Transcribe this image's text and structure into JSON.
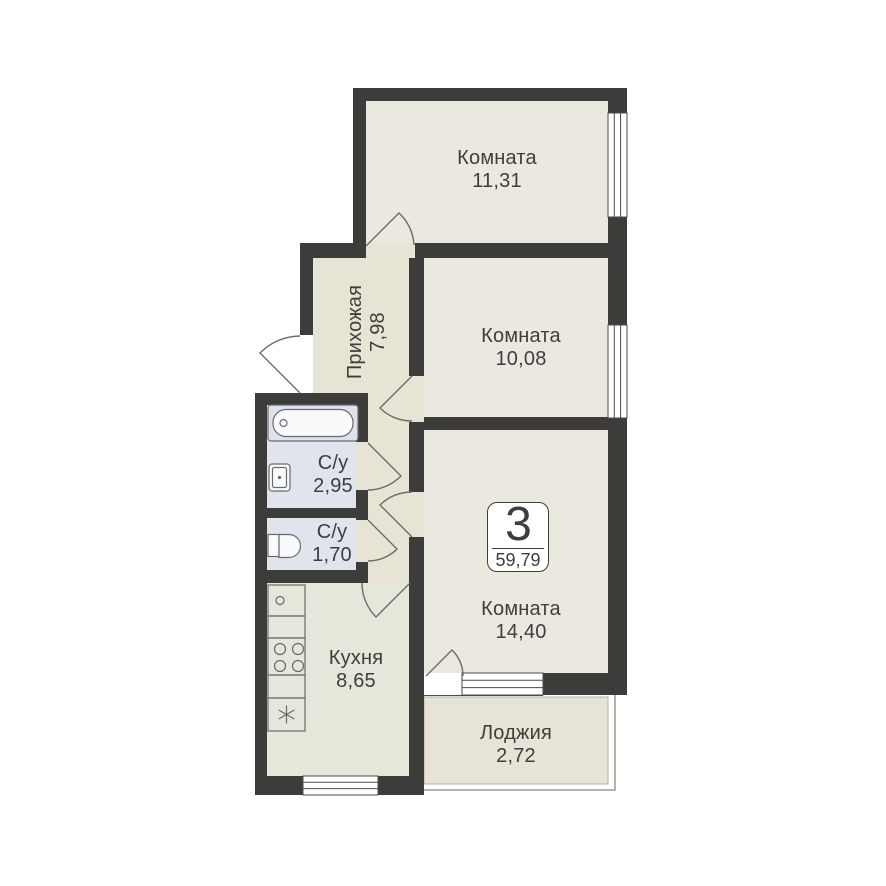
{
  "plan": {
    "badge": {
      "rooms_count": "3",
      "total_area": "59,79"
    },
    "rooms": [
      {
        "key": "room-1",
        "name": "Комната",
        "area": "11,31"
      },
      {
        "key": "hallway",
        "name": "Прихожая",
        "area": "7,98"
      },
      {
        "key": "room-2",
        "name": "Комната",
        "area": "10,08"
      },
      {
        "key": "bathroom",
        "name": "С/у",
        "area": "2,95"
      },
      {
        "key": "wc",
        "name": "С/у",
        "area": "1,70"
      },
      {
        "key": "kitchen",
        "name": "Кухня",
        "area": "8,65"
      },
      {
        "key": "room-3",
        "name": "Комната",
        "area": "14,40"
      },
      {
        "key": "loggia",
        "name": "Лоджия",
        "area": "2,72"
      }
    ],
    "icons": {
      "fixtures": [
        "bathtub-icon",
        "bath-sink-icon",
        "toilet-icon",
        "kitchen-sink-icon",
        "stove-icon",
        "freezer-icon"
      ],
      "symbols": [
        "door-swing",
        "window-symbol"
      ]
    },
    "colors": {
      "wall": "#3c3c3b",
      "room": "#ebe8e0",
      "hall": "#e8e4d5",
      "bath": "#e0e4ec",
      "kitchen": "#e4e7da",
      "loggia": "#e7e3d6",
      "text": "#3e3e3c",
      "frame": "#4b4b4b",
      "door": "#6b6b6b",
      "fixture": "#6a6a6a",
      "rail": "#8c8a7e"
    }
  }
}
